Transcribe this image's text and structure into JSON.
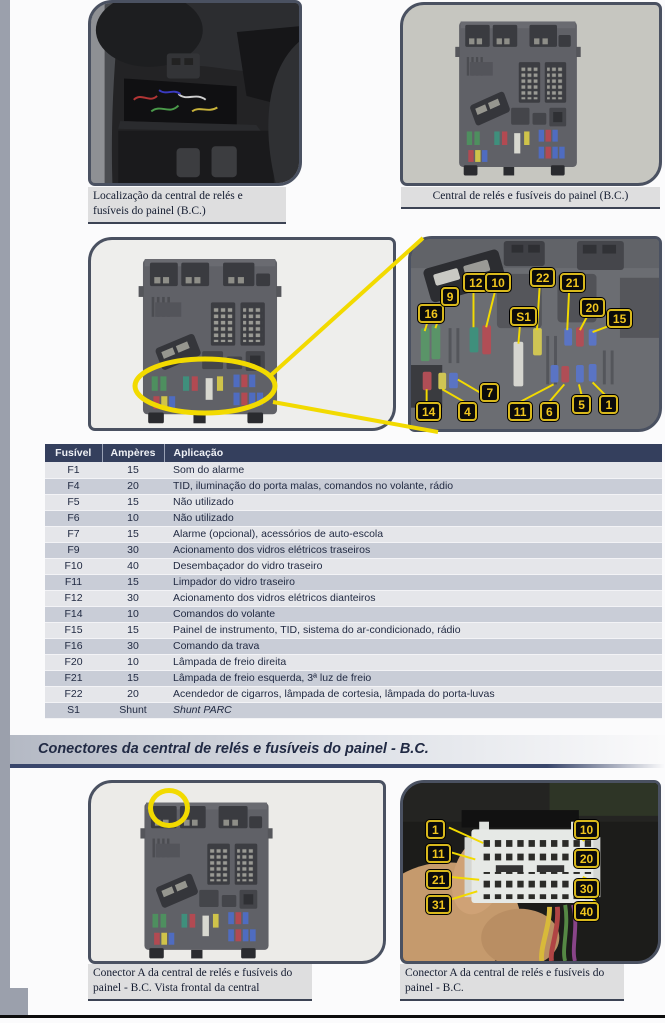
{
  "photos": {
    "location": {
      "caption": "Localização da central de relés e fusíveis do painel (B.C.)"
    },
    "central": {
      "caption": "Central de relés e fusíveis do painel (B.C.)"
    },
    "zoom": {
      "labels": [
        {
          "t": "16",
          "x": 3,
          "y": 34
        },
        {
          "t": "9",
          "x": 12,
          "y": 25
        },
        {
          "t": "12",
          "x": 21,
          "y": 18
        },
        {
          "t": "10",
          "x": 30,
          "y": 18
        },
        {
          "t": "S1",
          "x": 40,
          "y": 36
        },
        {
          "t": "22",
          "x": 48,
          "y": 15
        },
        {
          "t": "21",
          "x": 60,
          "y": 18
        },
        {
          "t": "20",
          "x": 68,
          "y": 31
        },
        {
          "t": "15",
          "x": 79,
          "y": 37
        },
        {
          "t": "7",
          "x": 28,
          "y": 76
        },
        {
          "t": "14",
          "x": 2,
          "y": 86
        },
        {
          "t": "4",
          "x": 19,
          "y": 86
        },
        {
          "t": "11",
          "x": 39,
          "y": 86
        },
        {
          "t": "6",
          "x": 52,
          "y": 86
        },
        {
          "t": "5",
          "x": 65,
          "y": 82
        },
        {
          "t": "1",
          "x": 76,
          "y": 82
        }
      ]
    },
    "connector_frontal": {
      "caption": "Conector A da central de relés e fusíveis do painel - B.C. Vista frontal da central"
    },
    "connector": {
      "caption": "Conector A da central de relés e fusíveis do painel - B.C.",
      "labels": [
        {
          "t": "1",
          "x": 9,
          "y": 21
        },
        {
          "t": "11",
          "x": 9,
          "y": 34
        },
        {
          "t": "21",
          "x": 9,
          "y": 49
        },
        {
          "t": "31",
          "x": 9,
          "y": 63
        },
        {
          "t": "10",
          "x": 67,
          "y": 21
        },
        {
          "t": "20",
          "x": 67,
          "y": 37
        },
        {
          "t": "30",
          "x": 67,
          "y": 54
        },
        {
          "t": "40",
          "x": 67,
          "y": 67
        }
      ]
    }
  },
  "fuse_table": {
    "headers": [
      "Fusível",
      "Ampères",
      "Aplicação"
    ],
    "rows": [
      [
        "F1",
        "15",
        "Som do alarme"
      ],
      [
        "F4",
        "20",
        "TID, iluminação do porta malas, comandos no volante, rádio"
      ],
      [
        "F5",
        "15",
        "Não utilizado"
      ],
      [
        "F6",
        "10",
        "Não utilizado"
      ],
      [
        "F7",
        "15",
        "Alarme (opcional), acessórios de auto-escola"
      ],
      [
        "F9",
        "30",
        "Acionamento dos vidros elétricos traseiros"
      ],
      [
        "F10",
        "40",
        "Desembaçador do vidro traseiro"
      ],
      [
        "F11",
        "15",
        "Limpador do vidro traseiro"
      ],
      [
        "F12",
        "30",
        "Acionamento dos vidros elétricos dianteiros"
      ],
      [
        "F14",
        "10",
        "Comandos do volante"
      ],
      [
        "F15",
        "15",
        "Painel de instrumento, TID, sistema do ar-condicionado, rádio"
      ],
      [
        "F16",
        "30",
        "Comando da trava"
      ],
      [
        "F20",
        "10",
        "Lâmpada de freio direita"
      ],
      [
        "F21",
        "15",
        "Lâmpada de freio esquerda, 3ª luz de freio"
      ],
      [
        "F22",
        "20",
        "Acendedor de cigarros, lâmpada de cortesia, lâmpada do porta-luvas"
      ],
      [
        "S1",
        "Shunt",
        "Shunt PARC"
      ]
    ],
    "italic_rows": [
      15
    ]
  },
  "section_header": {
    "title": "Conectores da central de relés e fusíveis do painel - B.C."
  },
  "colors": {
    "annotation_yellow": "#f2da00",
    "badge_text": "#f0c51e",
    "table_header_bg": "#343f5d",
    "row_light": "#e5e6ea",
    "row_dark": "#c9cdd7",
    "left_strip": "#9ba0ac"
  }
}
